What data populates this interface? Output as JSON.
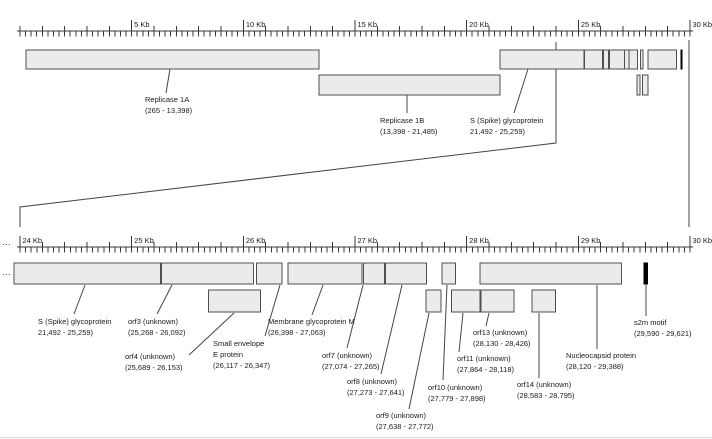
{
  "colors": {
    "background": "#ffffff",
    "box_fill": "#ebebeb",
    "box_border": "#4f4f4f",
    "s2m_fill": "#000000",
    "line": "#454545",
    "ruler": "#383838",
    "text": "#1a1a1a",
    "edge_line": "#d9d9d9"
  },
  "rulers": {
    "top": {
      "y": 31,
      "x_start": 17,
      "x_end": 693,
      "kb0": 0,
      "kb_max": 30,
      "origin_x": 20,
      "px_per_kb": 22.3333,
      "down_step": 0.25,
      "up_step": 1,
      "labels": [
        {
          "kb": 5,
          "text": "5 Kb"
        },
        {
          "kb": 10,
          "text": "10 Kb"
        },
        {
          "kb": 15,
          "text": "15 Kb"
        },
        {
          "kb": 20,
          "text": "20 Kb"
        },
        {
          "kb": 25,
          "text": "25 Kb"
        },
        {
          "kb": 30,
          "text": "30 Kb"
        }
      ]
    },
    "bottom": {
      "y": 247,
      "x_start": 17,
      "x_end": 693,
      "kb0": 24,
      "kb_max": 30,
      "origin_x": 20,
      "px_per_kb": 111.6667,
      "down_step": 0.05,
      "up_step": 0.2,
      "labels": [
        {
          "kb": 24,
          "text": "24 Kb"
        },
        {
          "kb": 25,
          "text": "25 Kb"
        },
        {
          "kb": 26,
          "text": "26 Kb"
        },
        {
          "kb": 27,
          "text": "27 Kb"
        },
        {
          "kb": 28,
          "text": "28 Kb"
        },
        {
          "kb": 29,
          "text": "29 Kb"
        },
        {
          "kb": 30,
          "text": "30 Kb"
        }
      ]
    }
  },
  "tracks": {
    "top": {
      "rows": [
        {
          "y": 50,
          "h": 19
        },
        {
          "y": 75,
          "h": 20
        }
      ],
      "features": [
        {
          "id": "replicase-1a",
          "start": 265,
          "end": 13398,
          "row": 0
        },
        {
          "id": "replicase-1b",
          "start": 13398,
          "end": 21485,
          "row": 1
        },
        {
          "id": "s-glycoprotein",
          "start": 21492,
          "end": 25259,
          "row": 0
        },
        {
          "id": "orf3",
          "start": 25268,
          "end": 26092,
          "row": 0
        },
        {
          "id": "e-protein",
          "start": 26117,
          "end": 26347,
          "row": 0
        },
        {
          "id": "m-glycoprotein",
          "start": 26398,
          "end": 27063,
          "row": 0
        },
        {
          "id": "orf7",
          "start": 27074,
          "end": 27265,
          "row": 0
        },
        {
          "id": "orf8",
          "start": 27273,
          "end": 27641,
          "row": 0
        },
        {
          "id": "orf9",
          "start": 27638,
          "end": 27772,
          "row": 1
        },
        {
          "id": "orf10",
          "start": 27779,
          "end": 27898,
          "row": 0
        },
        {
          "id": "orf11",
          "start": 27864,
          "end": 28118,
          "row": 1
        },
        {
          "id": "nucleocapsid",
          "start": 28120,
          "end": 29388,
          "row": 0
        },
        {
          "id": "s2m",
          "start": 29590,
          "end": 29621,
          "row": 0,
          "black": true
        }
      ]
    },
    "bottom": {
      "rows": [
        {
          "y": 263,
          "h": 21
        },
        {
          "y": 290,
          "h": 22
        }
      ],
      "features": [
        {
          "id": "s-glycoprotein",
          "start": 21492,
          "end": 25259,
          "row": 0,
          "clip_left_px": 14
        },
        {
          "id": "orf3",
          "start": 25268,
          "end": 26092,
          "row": 0
        },
        {
          "id": "orf4",
          "start": 25689,
          "end": 26153,
          "row": 1
        },
        {
          "id": "e-protein",
          "start": 26117,
          "end": 26347,
          "row": 0
        },
        {
          "id": "m-glycoprotein",
          "start": 26398,
          "end": 27063,
          "row": 0
        },
        {
          "id": "orf7",
          "start": 27074,
          "end": 27265,
          "row": 0
        },
        {
          "id": "orf8",
          "start": 27273,
          "end": 27641,
          "row": 0
        },
        {
          "id": "orf9",
          "start": 27638,
          "end": 27772,
          "row": 1
        },
        {
          "id": "orf10",
          "start": 27779,
          "end": 27898,
          "row": 0
        },
        {
          "id": "orf11",
          "start": 27864,
          "end": 28118,
          "row": 1
        },
        {
          "id": "orf13",
          "start": 28130,
          "end": 28426,
          "row": 1
        },
        {
          "id": "orf14",
          "start": 28583,
          "end": 28795,
          "row": 1
        },
        {
          "id": "nucleocapsid",
          "start": 28120,
          "end": 29388,
          "row": 0
        },
        {
          "id": "s2m",
          "start": 29590,
          "end": 29621,
          "row": 0,
          "black": true
        }
      ]
    }
  },
  "labels": {
    "top": [
      {
        "id": "replicase-1a",
        "x": 145,
        "y": 94,
        "lines": [
          "Replicase 1A",
          "(265 - 13,398)"
        ],
        "line_px": [
          170,
          69,
          166,
          93
        ]
      },
      {
        "id": "replicase-1b",
        "x": 380,
        "y": 115,
        "lines": [
          "Replicase 1B",
          "(13,398 - 21,485)"
        ],
        "line_px": [
          407,
          95,
          407,
          113
        ]
      },
      {
        "id": "s-glycoprotein",
        "x": 470,
        "y": 115,
        "lines": [
          "S (Spike) glycoprotein",
          "21,492 - 25,259)"
        ],
        "line_px": [
          528,
          69,
          514,
          113
        ]
      }
    ],
    "bottom": [
      {
        "id": "s-glycoprotein",
        "x": 38,
        "y": 316,
        "lines": [
          "S (Spike) glycoprotein",
          "21,492 - 25,259)"
        ],
        "line_px": [
          85,
          285,
          74,
          314
        ]
      },
      {
        "id": "orf3",
        "x": 128,
        "y": 316,
        "lines": [
          "orf3 (unknown)",
          "(25,268 - 26,092)"
        ],
        "line_px": [
          172,
          285,
          157,
          314
        ]
      },
      {
        "id": "orf4",
        "x": 125,
        "y": 351,
        "lines": [
          "orf4 (unknown)",
          "(25,689 - 26,153)"
        ],
        "line_px": [
          234,
          313,
          189,
          355
        ]
      },
      {
        "id": "e-protein",
        "x": 213,
        "y": 338,
        "lines": [
          "Small envelope",
          "E protein",
          "(26,117 - 26,347)"
        ],
        "line_px": [
          280,
          285,
          265,
          336
        ]
      },
      {
        "id": "m-glycoprotein",
        "x": 268,
        "y": 316,
        "lines": [
          "Membrane glycoprotein M",
          "(26,398 - 27,063)"
        ],
        "line_px": [
          323,
          285,
          312,
          315
        ]
      },
      {
        "id": "orf7",
        "x": 322,
        "y": 350,
        "lines": [
          "orf7 (unknown)",
          "(27,074 - 27,265)"
        ],
        "line_px": [
          363,
          285,
          347,
          348
        ]
      },
      {
        "id": "orf8",
        "x": 347,
        "y": 376,
        "lines": [
          "orf8 (unknown)",
          "(27,273 - 27,641)"
        ],
        "line_px": [
          402,
          285,
          381,
          374
        ]
      },
      {
        "id": "orf9",
        "x": 376,
        "y": 410,
        "lines": [
          "orf9 (unknown)",
          "(27,638 - 27,772)"
        ],
        "line_px": [
          429,
          313,
          409,
          409
        ]
      },
      {
        "id": "orf10",
        "x": 428,
        "y": 382,
        "lines": [
          "orf10 (unknown)",
          "(27,779 - 27,898)"
        ],
        "line_px": [
          447,
          285,
          443,
          380
        ]
      },
      {
        "id": "orf11",
        "x": 457,
        "y": 353,
        "lines": [
          "orf11 (unknown)",
          "(27,864 - 28,118)"
        ],
        "line_px": [
          463,
          313,
          459,
          352
        ]
      },
      {
        "id": "orf13",
        "x": 473,
        "y": 327,
        "lines": [
          "orf13 (unknown)",
          "(28,130 - 28,426)"
        ],
        "line_px": [
          489,
          313,
          486,
          326
        ]
      },
      {
        "id": "orf14",
        "x": 517,
        "y": 379,
        "lines": [
          "orf14 (unknown)",
          "(28,583 - 28,795)"
        ],
        "line_px": [
          539,
          313,
          539,
          378
        ]
      },
      {
        "id": "nucleocapsid",
        "x": 566,
        "y": 350,
        "lines": [
          "Nucleocapsid protein",
          "(28,120 - 29,388)"
        ],
        "line_px": [
          597,
          285,
          597,
          349
        ]
      },
      {
        "id": "s2m",
        "x": 634,
        "y": 317,
        "lines": [
          "s2m motif",
          "(29,590 - 29,621)"
        ],
        "line_px": [
          646,
          285,
          646,
          316
        ]
      }
    ]
  },
  "connectors": {
    "zoom_left": [
      [
        556,
        42
      ],
      [
        556,
        143
      ],
      [
        20,
        207
      ],
      [
        20,
        227
      ]
    ],
    "zoom_right": [
      [
        689,
        40
      ],
      [
        689,
        227
      ]
    ]
  },
  "marks": {
    "ruler_ellipsis": "...",
    "row_ellipsis": "..."
  }
}
